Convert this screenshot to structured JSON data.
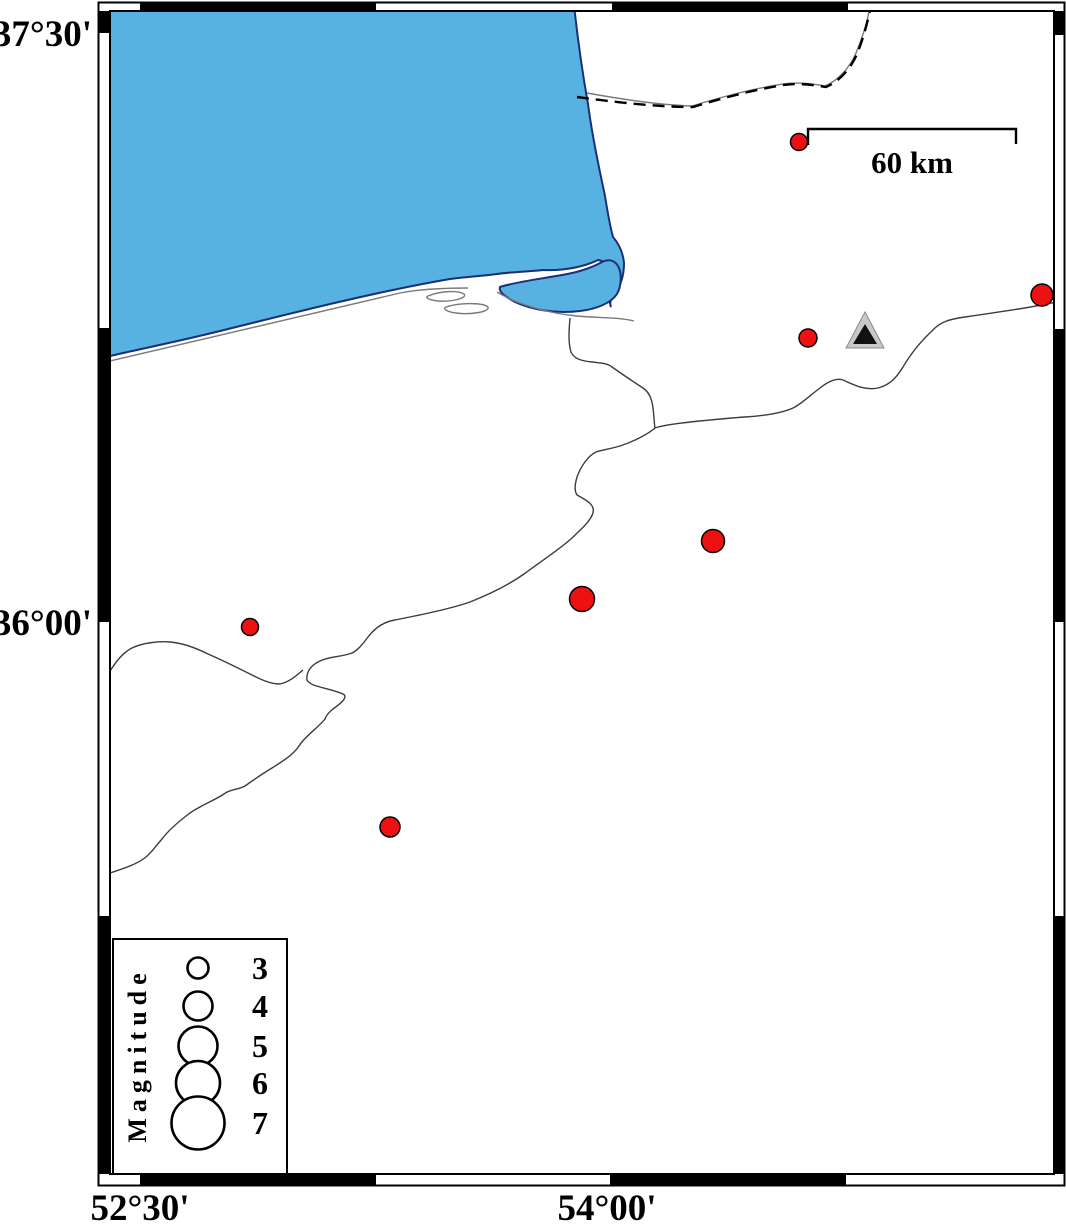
{
  "map_title": "Seismicity map with station and magnitude legend",
  "colors": {
    "sea": "#57B1E1",
    "sea_outline": "#1b2f78",
    "quake_fill": "#EE1111",
    "quake_stroke": "#000000",
    "station_outer": "#C9C9C9",
    "station_inner": "#111111",
    "coast": "#7a7a7a",
    "river": "#3c3c3c"
  },
  "frame": {
    "y_axis_labels": [
      {
        "text": "37°30'",
        "y": 33
      },
      {
        "text": "36°00'",
        "y": 622
      }
    ],
    "x_axis_labels": [
      {
        "text": "52°30'",
        "x": 140
      },
      {
        "text": "54°00'",
        "x": 607
      }
    ]
  },
  "scale_bar": {
    "label": "60 km",
    "x1": 808,
    "x2": 1016,
    "y": 129
  },
  "legend": {
    "title": "Magnitude",
    "circle_cx": 198,
    "label_x": 260,
    "entries": [
      {
        "label": "3",
        "cy": 968,
        "r": 10.5
      },
      {
        "label": "4",
        "cy": 1006,
        "r": 14.5
      },
      {
        "label": "5",
        "cy": 1046,
        "r": 19.5
      },
      {
        "label": "6",
        "cy": 1083,
        "r": 22
      },
      {
        "label": "7",
        "cy": 1123,
        "r": 26.5
      }
    ]
  },
  "earthquakes": {
    "symbol": "red-circle",
    "points": [
      {
        "x": 799,
        "y": 142,
        "d": 17
      },
      {
        "x": 1042,
        "y": 295,
        "d": 22
      },
      {
        "x": 808,
        "y": 338,
        "d": 18
      },
      {
        "x": 713,
        "y": 541,
        "d": 23
      },
      {
        "x": 582,
        "y": 599,
        "d": 25
      },
      {
        "x": 250,
        "y": 627,
        "d": 17
      },
      {
        "x": 390,
        "y": 827,
        "d": 20
      }
    ]
  },
  "station": {
    "symbol": "triangle",
    "x": 865,
    "y": 332
  }
}
